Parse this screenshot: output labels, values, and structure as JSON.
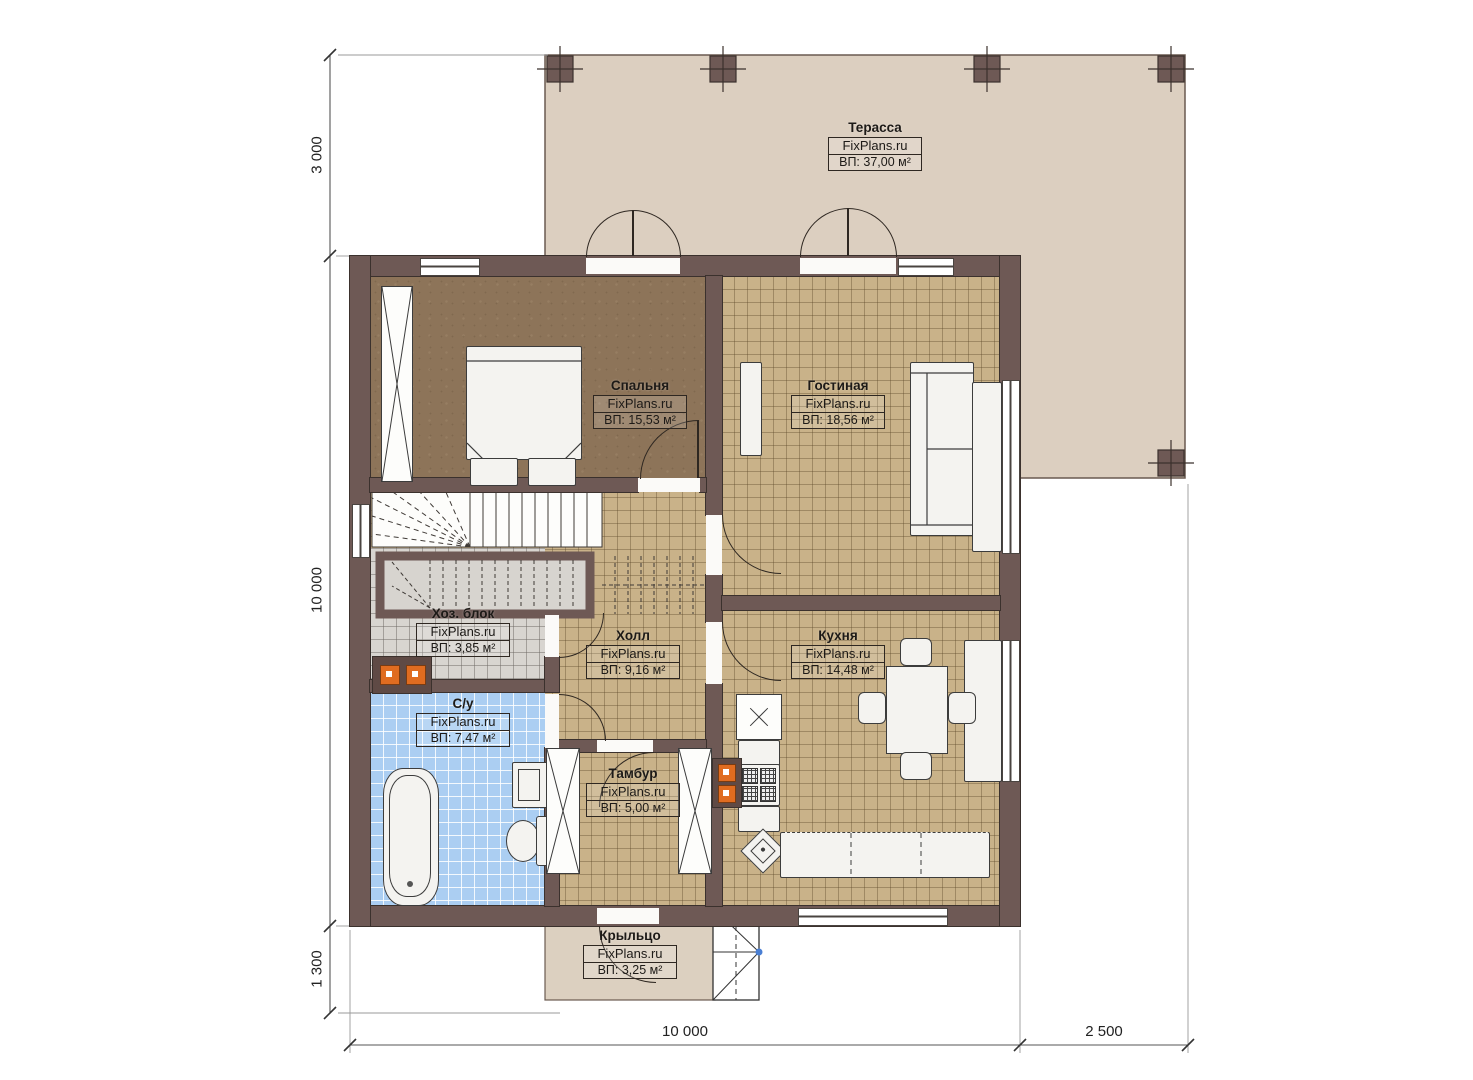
{
  "watermark": "FixPlans.ru",
  "rooms": {
    "terrace": {
      "name": "Терасса",
      "area": "ВП: 37,00 м²"
    },
    "bedroom": {
      "name": "Спальня",
      "area": "ВП: 15,53 м²"
    },
    "living": {
      "name": "Гостиная",
      "area": "ВП: 18,56 м²"
    },
    "utility": {
      "name": "Хоз. блок",
      "area": "ВП: 3,85 м²"
    },
    "hall": {
      "name": "Холл",
      "area": "ВП: 9,16 м²"
    },
    "kitchen": {
      "name": "Кухня",
      "area": "ВП: 14,48 м²"
    },
    "bathroom": {
      "name": "С/у",
      "area": "ВП: 7,47 м²"
    },
    "vestibule": {
      "name": "Тамбур",
      "area": "ВП: 5,00 м²"
    },
    "porch": {
      "name": "Крыльцо",
      "area": "ВП: 3,25 м²"
    }
  },
  "dimensions": {
    "terrace_depth": "3 000",
    "house_height": "10 000",
    "porch_depth": "1 300",
    "house_width": "10 000",
    "terrace_width": "2 500"
  },
  "colors": {
    "wall": "#6e5955",
    "terrace": "#dccfc0",
    "tan_floor": "#c9b289",
    "blue_floor": "#abcef2",
    "gray_floor": "#d8d5d0",
    "bedroom_floor": "#8d7459",
    "accent_orange": "#e06c20"
  }
}
